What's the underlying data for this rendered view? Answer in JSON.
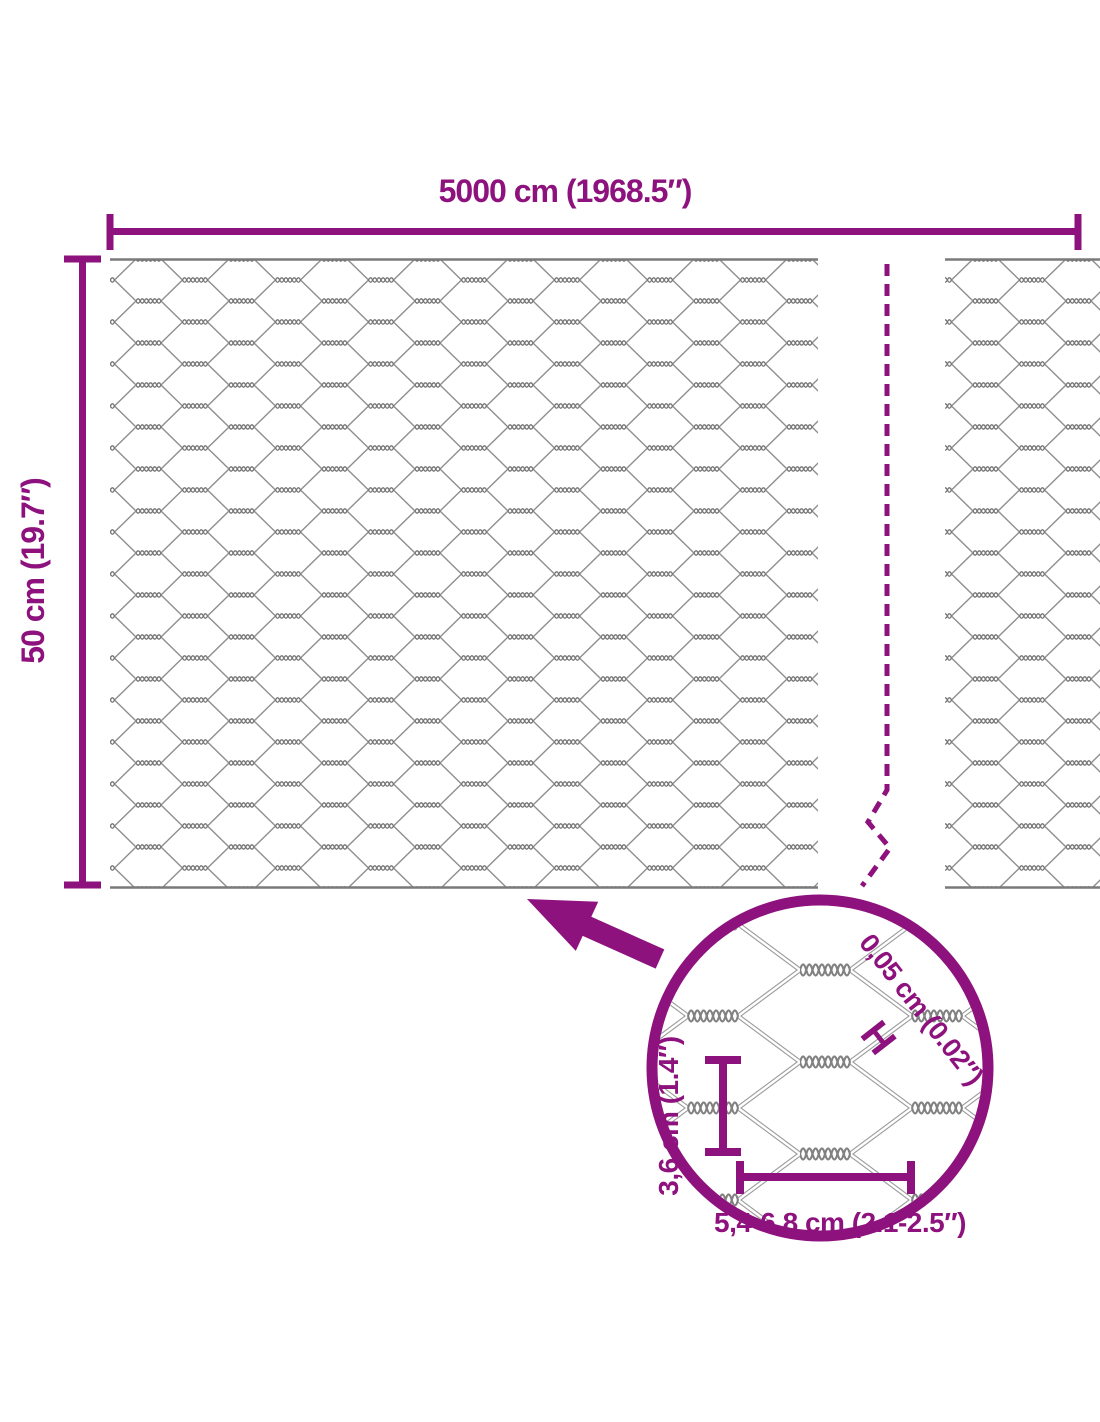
{
  "diagram": {
    "accent_color": "#8E127E",
    "wire_color": "#8E8E8E",
    "wire_dark_color": "#757575",
    "top_dimension_label": "5000 cm (1968.5″)",
    "side_dimension_label": "50 cm (19.7″)",
    "magnifier": {
      "wire_diameter_label": "0,05 cm (0.02″)",
      "wire_marker": "H",
      "cell_height_label": "3,6 cm (1.4″)",
      "cell_width_label": "5,4-6,8 cm (2.1-2.5″)"
    }
  }
}
